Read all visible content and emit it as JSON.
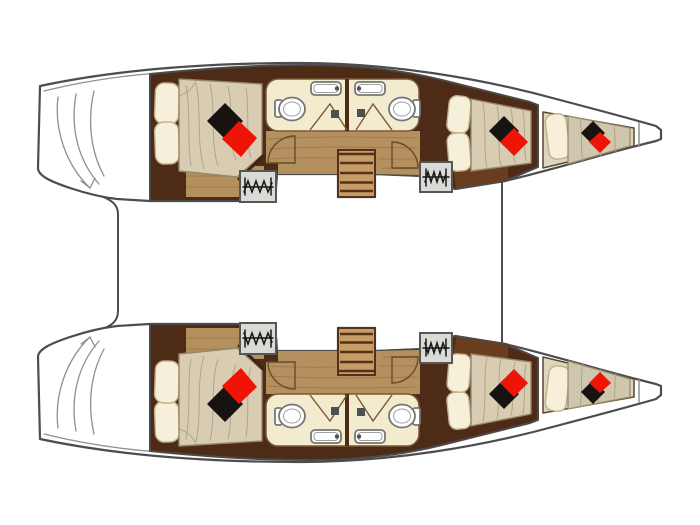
{
  "page": {
    "background": "#ffffff",
    "description": "Top-down interior layout plan of a sailing catamaran: two mirrored hulls, bows pointing right, joined by two crossbeam lines; no text labels are rendered in the drawing"
  },
  "colors": {
    "page_bg": "#ffffff",
    "hull_fill": "#ffffff",
    "hull_outline": "#4d4d4d",
    "transom_line": "#8f8f8f",
    "wall_wood": "#4e2b16",
    "wall_stroke": "#4a4a4a",
    "floor_wood": "#b3905e",
    "floor_dark": "#6b3d1f",
    "floor_grain": "#8a6a42",
    "stairs_wood": "#c69d66",
    "stairs_line": "#57301a",
    "bathroom_floor": "#f2ebcd",
    "bathroom_line": "#7b5a36",
    "fixture_white": "#ffffff",
    "fixture_stroke": "#767676",
    "shower_square": "#4f4f4f",
    "mattress": "#d8ccb2",
    "mattress_bow": "#cfc6ae",
    "mattress_edge": "#97876a",
    "mattress_line": "#aa9b80",
    "pillow": "#f6f0da",
    "pillow_stroke": "#c2b189",
    "cushion_black": "#171310",
    "cushion_red": "#ee1408",
    "wardrobe_fill": "#dadad6",
    "wardrobe_stroke": "#565656",
    "hanger_line": "#161616",
    "door_line": "#6b4a2a",
    "bed_frame": "#3f2310",
    "berth_floor": "#ddd5bd",
    "berth_line": "#5a4632"
  },
  "plan": {
    "vessel_type": "catamaran",
    "view": "top-down interior plan",
    "hulls": [
      {
        "name": "top-hull",
        "rooms": [
          {
            "name": "aft-cabin",
            "furniture": [
              "double-bed",
              "pillow",
              "pillow",
              "black-cushion",
              "red-cushion",
              "wardrobe"
            ]
          },
          {
            "name": "aft-bathroom",
            "fixtures": [
              "toilet",
              "sink",
              "shower-triangle",
              "shower-drain"
            ]
          },
          {
            "name": "forward-bathroom",
            "fixtures": [
              "toilet",
              "sink",
              "shower-triangle",
              "shower-drain"
            ]
          },
          {
            "name": "companionway-stairs",
            "steps": 4
          },
          {
            "name": "forward-cabin",
            "furniture": [
              "double-bed",
              "pillow",
              "pillow",
              "black-cushion",
              "red-cushion",
              "wardrobe"
            ]
          },
          {
            "name": "bow-berth",
            "furniture": [
              "berth",
              "pillow",
              "black-cushion",
              "red-cushion"
            ]
          }
        ],
        "stern_feature": "transom-step-curves",
        "bow_feature": "chamfered-bow-tip"
      },
      {
        "name": "bottom-hull",
        "mirror_of": "top-hull"
      }
    ],
    "crossbeam_lines": 2,
    "totals": {
      "wardrobes": 4,
      "black_cushions": 6,
      "red_cushions": 6,
      "toilets": 4,
      "sinks": 4,
      "showers": 4,
      "stairs": 2
    }
  }
}
